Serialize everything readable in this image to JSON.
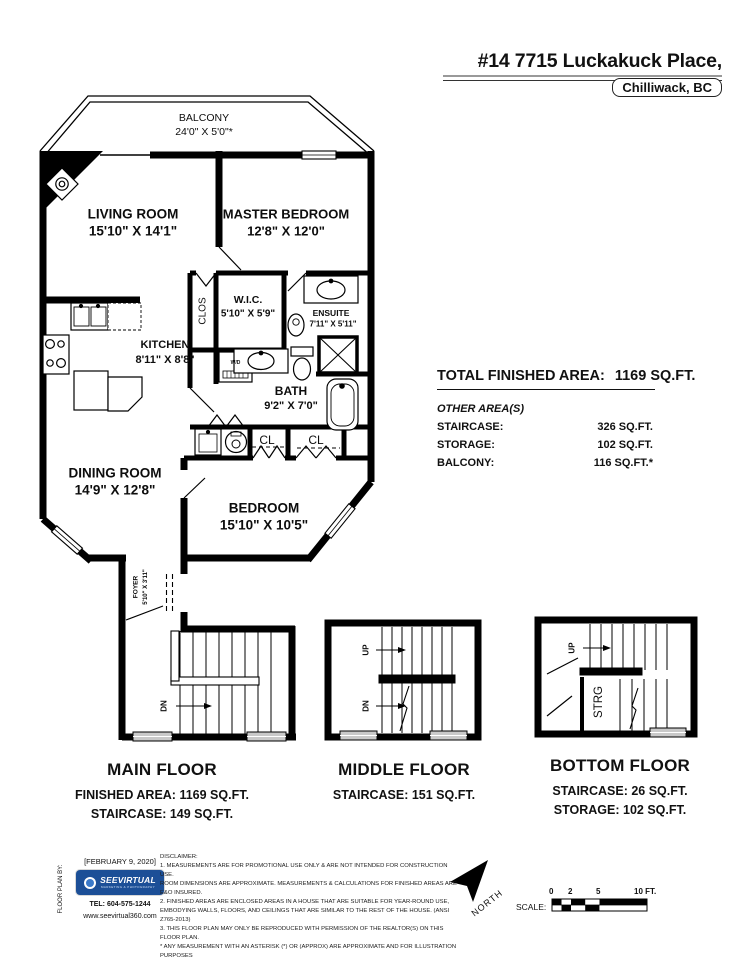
{
  "header": {
    "address": "#14 7715 Luckakuck Place,",
    "city": "Chilliwack, BC"
  },
  "rooms": {
    "balcony": {
      "name": "BALCONY",
      "dims": "24'0\" X 5'0\"*"
    },
    "living_room": {
      "name": "LIVING ROOM",
      "dims": "15'10\" X 14'1\""
    },
    "master_bedroom": {
      "name": "MASTER BEDROOM",
      "dims": "12'8\" X 12'0\""
    },
    "wic": {
      "name": "W.I.C.",
      "dims": "5'10\" X 5'9\""
    },
    "ensuite": {
      "name": "ENSUITE",
      "dims": "7'11\" X 5'11\""
    },
    "kitchen": {
      "name": "KITCHEN",
      "dims": "8'11\" X 8'8\""
    },
    "bath": {
      "name": "BATH",
      "dims": "9'2\" X 7'0\""
    },
    "dining_room": {
      "name": "DINING ROOM",
      "dims": "14'9\" X 12'8\""
    },
    "bedroom": {
      "name": "BEDROOM",
      "dims": "15'10\" X 10'5\""
    },
    "foyer": {
      "name": "FOYER",
      "dims": "5'10\" X 3'11\""
    },
    "clos": "CLOS",
    "cl1": "CL",
    "cl2": "CL",
    "wd": "W/D",
    "strg": "STRG"
  },
  "stairs": {
    "dn": "DN",
    "up": "UP"
  },
  "summary": {
    "total_label": "TOTAL FINISHED AREA:",
    "total_value": "1169 SQ.FT.",
    "other_label": "OTHER AREA(S)",
    "rows": [
      {
        "label": "STAIRCASE:",
        "value": "326 SQ.FT."
      },
      {
        "label": "STORAGE:",
        "value": "102 SQ.FT."
      },
      {
        "label": "BALCONY:",
        "value": "116 SQ.FT.*"
      }
    ]
  },
  "floors": [
    {
      "title": "MAIN FLOOR",
      "lines": [
        "FINISHED AREA: 1169 SQ.FT.",
        "STAIRCASE: 149 SQ.FT."
      ]
    },
    {
      "title": "MIDDLE FLOOR",
      "lines": [
        "STAIRCASE: 151 SQ.FT."
      ]
    },
    {
      "title": "BOTTOM FLOOR",
      "lines": [
        "STAIRCASE: 26 SQ.FT.",
        "STORAGE: 102 SQ.FT."
      ]
    }
  ],
  "footer": {
    "by_label": "FLOOR PLAN BY:",
    "date": "[FEBRUARY 9, 2020]",
    "logo_text": "SEEVIRTUAL",
    "logo_sub": "MARKETING & PHOTOGRAPHY",
    "tel": "TEL: 604-575-1244",
    "web": "www.seevirtual360.com",
    "north_label": "NORTH",
    "scale_label": "SCALE:",
    "scale_ticks": [
      "0",
      "2",
      "5",
      "10 FT."
    ],
    "disclaimer": [
      "DISCLAIMER:",
      "1. MEASUREMENTS ARE FOR PROMOTIONAL USE ONLY & ARE NOT INTENDED FOR CONSTRUCTION USE.",
      "ROOM DIMENSIONS ARE APPROXIMATE. MEASUREMENTS & CALCULATIONS FOR FINISHED AREAS ARE E&O INSURED.",
      "2. FINISHED AREAS ARE ENCLOSED AREAS IN A HOUSE THAT ARE SUITABLE FOR YEAR-ROUND USE,",
      "EMBODYING WALLS, FLOORS, AND CEILINGS THAT ARE SIMILAR TO THE REST OF THE HOUSE. (ANSI Z765-2013)",
      "3. THIS FLOOR PLAN MAY ONLY BE REPRODUCED WITH PERMISSION OF THE REALTOR(S) ON THIS FLOOR PLAN.",
      "* ANY MEASUREMENT WITH AN ASTERISK (*) OR (APPROX) ARE APPROXIMATE AND FOR ILLUSTRATION PURPOSES",
      "ONLY AND ARE NOT E&O INSURED."
    ]
  },
  "colors": {
    "wall": "#000000",
    "window_gray": "#c9c9c9",
    "logo_blue": "#1c4f97"
  }
}
